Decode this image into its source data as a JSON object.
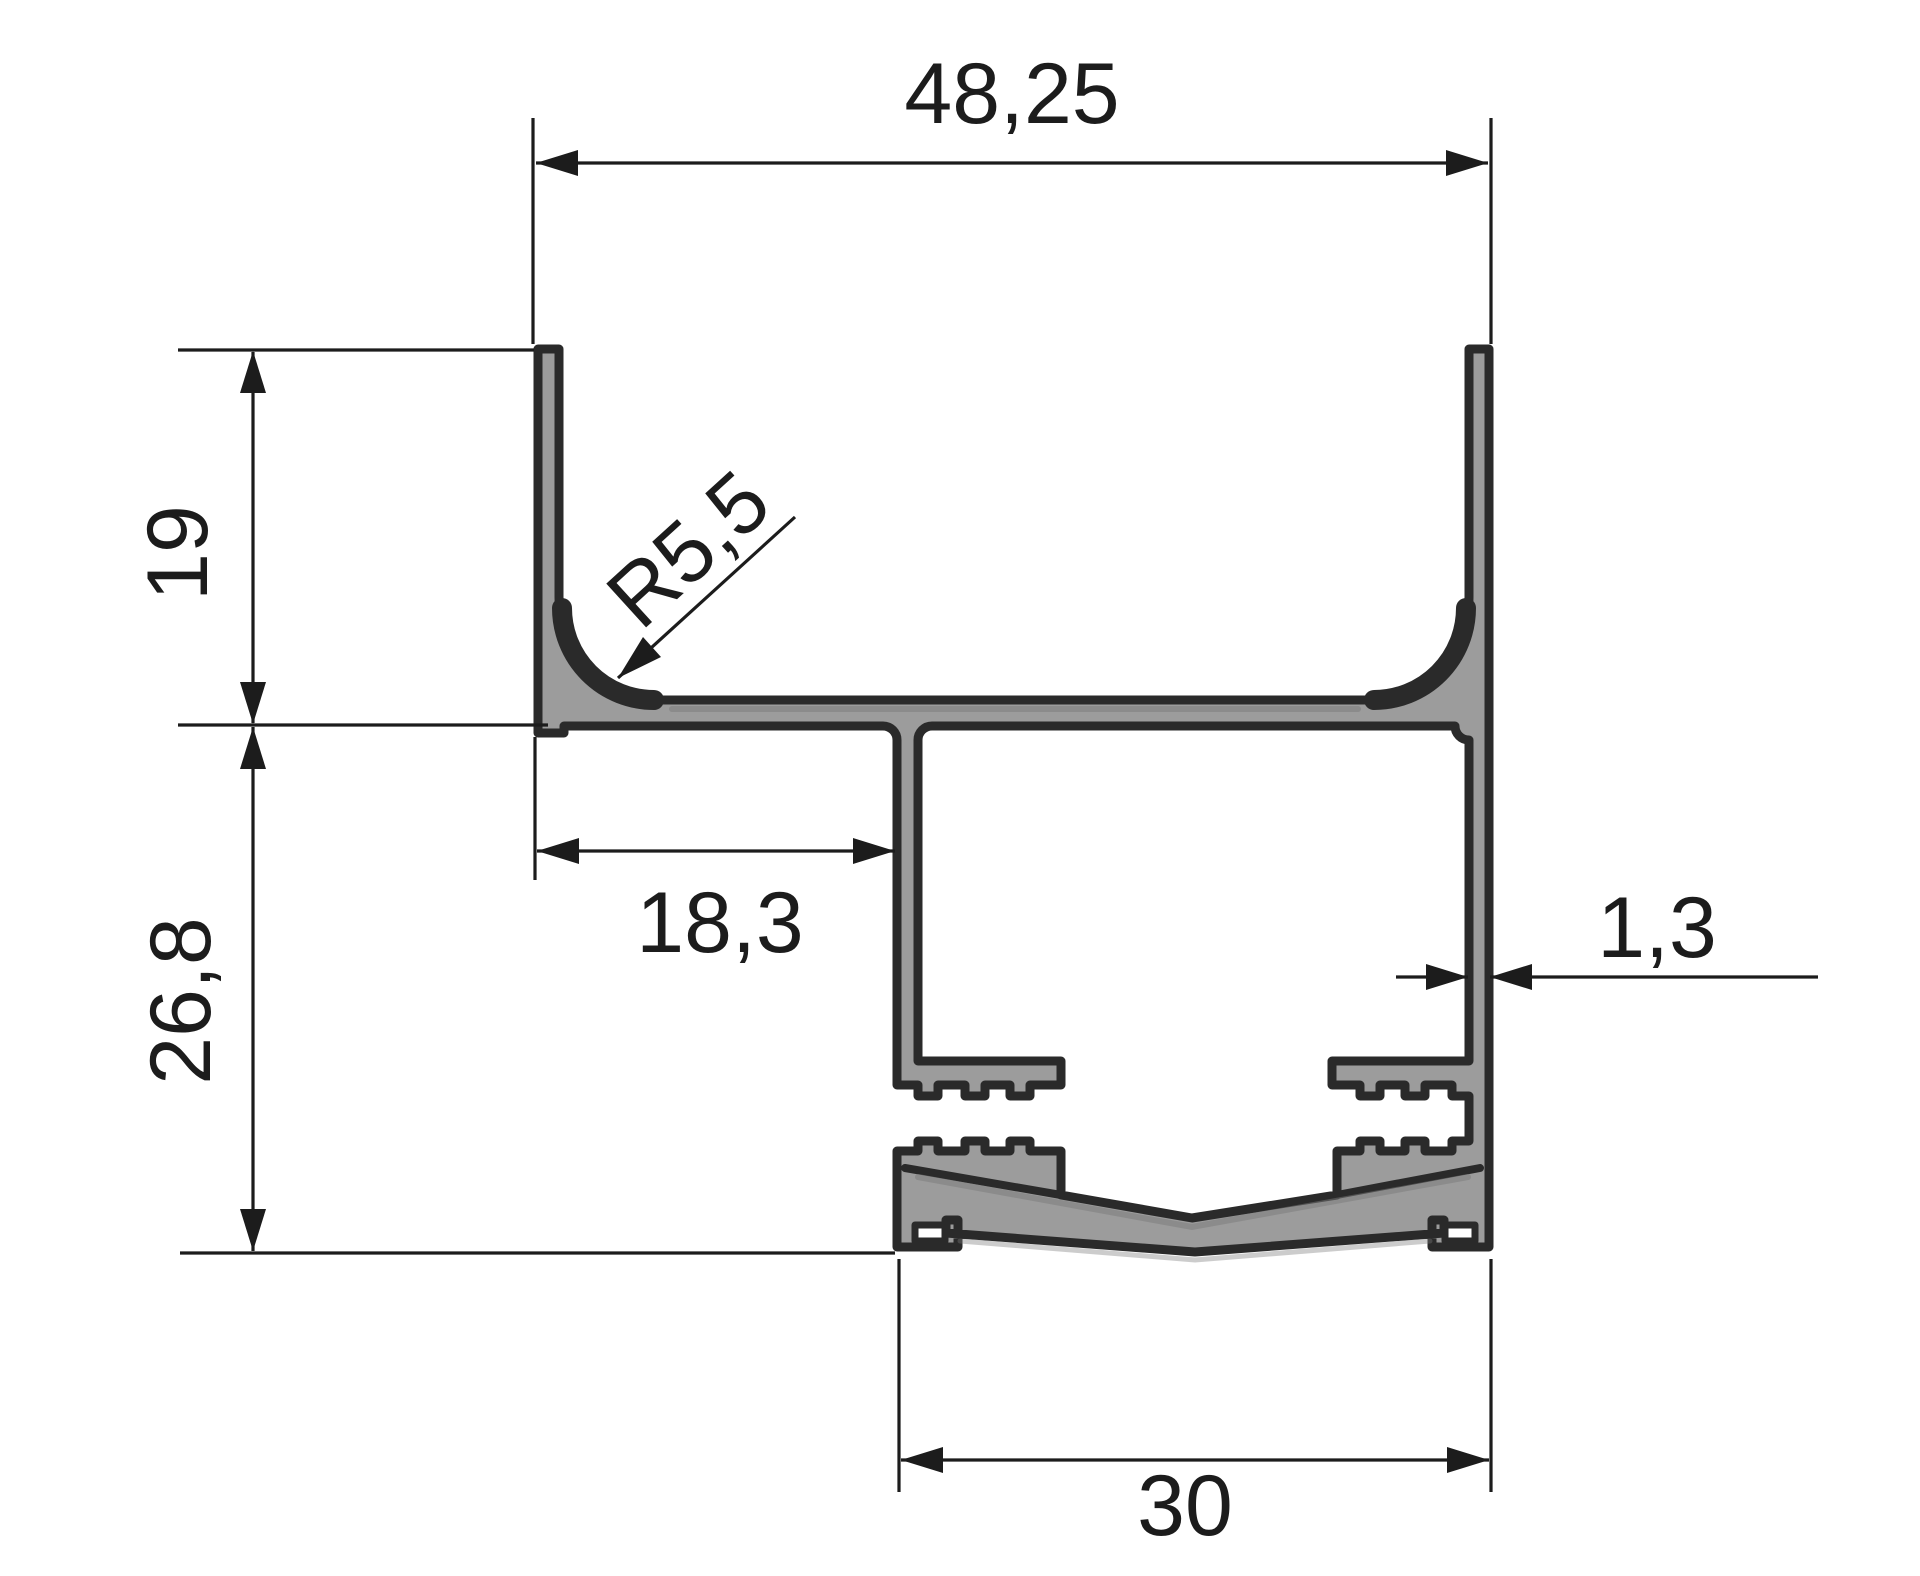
{
  "drawing": {
    "title": "aluminium-profile-cross-section",
    "units_style": "millimetres-comma-decimal",
    "dims": {
      "width_top": "48,25",
      "height_upper": "19",
      "height_lower": "26,8",
      "corner_radius": "R5,5",
      "inset_left": "18,3",
      "wall_thickness": "1,3",
      "width_bottom": "30"
    },
    "colors": {
      "outline": "#2a2a2a",
      "metal": "#9c9c9c",
      "dim": "#1c1c1c",
      "bg": "#ffffff",
      "shadow": "#7a7a7a"
    }
  }
}
